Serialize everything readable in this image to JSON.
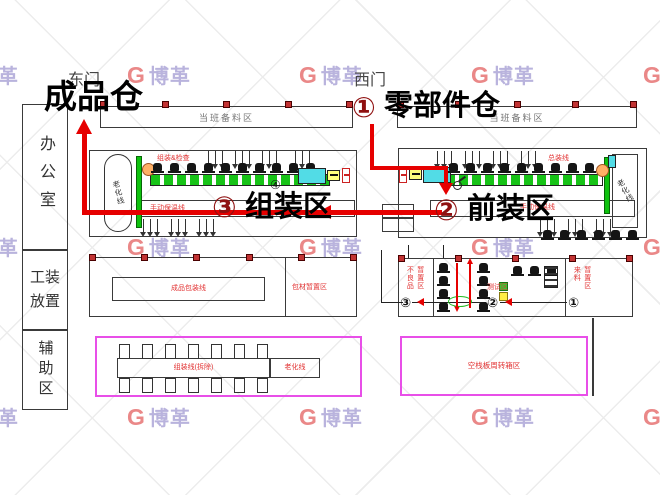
{
  "watermark": {
    "mark": "G",
    "text": "博革"
  },
  "gates": {
    "east": "东门",
    "west": "西门"
  },
  "rooms": {
    "office": "办公室",
    "tooling": "工装放置",
    "auxiliary": "辅助区"
  },
  "prep": {
    "left": "当班备料区",
    "right": "当班备料区"
  },
  "flow": {
    "finished": "成品仓",
    "step1_num": "①",
    "step1_label": "零部件仓",
    "step2_num": "②",
    "step2_label": "前装区",
    "step3_num": "③",
    "step3_label": "组装区"
  },
  "bays": {
    "left": {
      "aging": "老化线",
      "line_label": "组装&检查",
      "manual": "手动保温线",
      "station": "④"
    },
    "right": {
      "aging": "老化线",
      "line_label": "总装线",
      "manual": "手动保温线"
    }
  },
  "middle": {
    "left": {
      "packing_line": "成品包装线",
      "staging": "包材暂置区"
    },
    "right": {
      "left_staging": [
        "不良品",
        "暂置区"
      ],
      "center": "测试区",
      "right_staging": [
        "来料",
        "暂置区"
      ],
      "steps": [
        "③",
        "②",
        "①"
      ]
    }
  },
  "bottom": {
    "left": {
      "line1": "组装线(拆除)",
      "line2": "老化线"
    },
    "right": {
      "label": "空栈板周转箱区"
    }
  }
}
